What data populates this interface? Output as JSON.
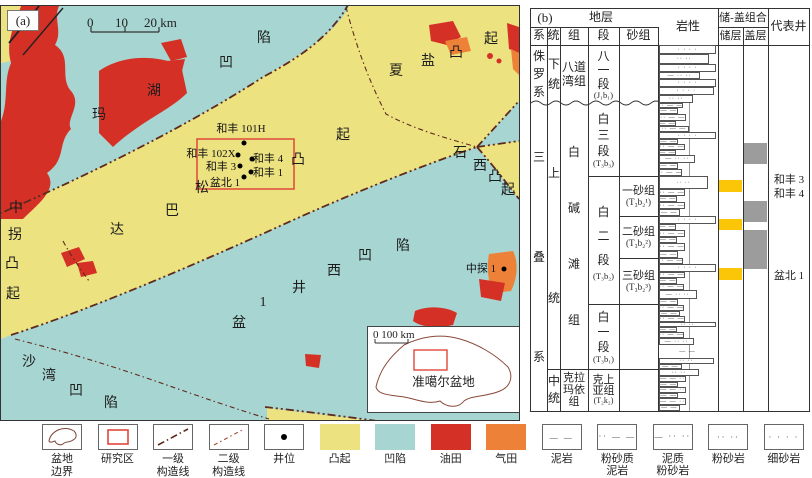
{
  "figure": {
    "panel_a_label": "(a)",
    "panel_b_label": "(b)"
  },
  "colors": {
    "uplift_yellow": "#ece280",
    "depression_teal": "#a7d5d1",
    "oilfield_red": "#d53026",
    "gasfield_orange": "#ee8138",
    "structure_line": "#5f2a1e",
    "study_rect_red": "#e0483a",
    "reservoir_yellow": "#fbc608",
    "cap_gray": "#9c9c9c"
  },
  "map": {
    "scalebar": {
      "t0": "0",
      "t10": "10",
      "t20": "20 km"
    },
    "region_labels": [
      {
        "t": "玛",
        "x": 98,
        "y": 113
      },
      {
        "t": "湖",
        "x": 153,
        "y": 89
      },
      {
        "t": "凹",
        "x": 225,
        "y": 61
      },
      {
        "t": "陷",
        "x": 263,
        "y": 36
      },
      {
        "t": "夏",
        "x": 395,
        "y": 69
      },
      {
        "t": "盐",
        "x": 427,
        "y": 59
      },
      {
        "t": "凸",
        "x": 455,
        "y": 51
      },
      {
        "t": "起",
        "x": 490,
        "y": 37
      },
      {
        "t": "达",
        "x": 116,
        "y": 228
      },
      {
        "t": "巴",
        "x": 171,
        "y": 209
      },
      {
        "t": "松",
        "x": 201,
        "y": 186
      },
      {
        "t": "凸",
        "x": 297,
        "y": 158
      },
      {
        "t": "起",
        "x": 342,
        "y": 133
      },
      {
        "t": "中",
        "x": 15,
        "y": 206
      },
      {
        "t": "拐",
        "x": 14,
        "y": 233
      },
      {
        "t": "凸",
        "x": 11,
        "y": 262
      },
      {
        "t": "起",
        "x": 12,
        "y": 292
      },
      {
        "t": "沙",
        "x": 28,
        "y": 360
      },
      {
        "t": "湾",
        "x": 48,
        "y": 374
      },
      {
        "t": "凹",
        "x": 75,
        "y": 389
      },
      {
        "t": "陷",
        "x": 110,
        "y": 401
      },
      {
        "t": "盆",
        "x": 238,
        "y": 321
      },
      {
        "t": "1",
        "x": 262,
        "y": 302
      },
      {
        "t": "井",
        "x": 298,
        "y": 286
      },
      {
        "t": "西",
        "x": 333,
        "y": 269
      },
      {
        "t": "凹",
        "x": 364,
        "y": 254
      },
      {
        "t": "陷",
        "x": 402,
        "y": 244
      },
      {
        "t": "石",
        "x": 459,
        "y": 151
      },
      {
        "t": "西",
        "x": 479,
        "y": 164
      },
      {
        "t": "凸",
        "x": 494,
        "y": 175
      },
      {
        "t": "起",
        "x": 507,
        "y": 188
      }
    ],
    "wells": [
      {
        "name": "和丰 101H",
        "lx": 240,
        "ly": 127,
        "dx": 243,
        "dy": 142
      },
      {
        "name": "和丰 102X",
        "lx": 210,
        "ly": 152,
        "dx": 237,
        "dy": 154
      },
      {
        "name": "和丰 4",
        "lx": 267,
        "ly": 157,
        "dx": 251,
        "dy": 158
      },
      {
        "name": "和丰 3",
        "lx": 220,
        "ly": 165,
        "dx": 239,
        "dy": 165
      },
      {
        "name": "和丰 1",
        "lx": 267,
        "ly": 171,
        "dx": 250,
        "dy": 171
      },
      {
        "name": "盆北 1",
        "lx": 224,
        "ly": 181,
        "dx": 243,
        "dy": 176
      },
      {
        "name": "中探 1",
        "lx": 480,
        "ly": 267,
        "dx": 503,
        "dy": 268
      }
    ],
    "inset": {
      "scale": "0    100 km",
      "label": "准噶尔盆地"
    }
  },
  "strat": {
    "header": {
      "dc": "地层",
      "sys": "系",
      "ser": "统",
      "fm": "组",
      "mem": "段",
      "sand": "砂组",
      "lith": "岩性",
      "rc": "储-盖组合",
      "res": "储层",
      "cap": "盖层",
      "rep": "代表井"
    },
    "cells": {
      "j_sys": "侏罗系",
      "j_ser": "下统",
      "j_fm": "八道湾组",
      "j_mem": "八一段",
      "j_mem_sub": "(J₁b₁)",
      "t_sys": "三叠系",
      "t_ser_u": "上统",
      "t_ser_m": "中统",
      "t_fm_b": "白碱滩组",
      "t_fm_k": "克拉玛依组",
      "b3": "白三段",
      "b3_sub": "(T₃b₃)",
      "b2": "白二段",
      "b2_sub": "(T₃b₂)",
      "b1": "白一段",
      "b1_sub": "(T₃b₁)",
      "k2": "克上亚组",
      "k2_sub": "(T₂k₂)",
      "sg1": "一砂组",
      "sg1_sub": "(T₃b₂¹)",
      "sg2": "二砂组",
      "sg2_sub": "(T₃b₂²)",
      "sg3": "三砂组",
      "sg3_sub": "(T₃b₂³)"
    },
    "rep_wells": [
      {
        "t": "和丰 3",
        "y": 162
      },
      {
        "t": "和丰 4",
        "y": 176
      },
      {
        "t": "盆北 1",
        "y": 258
      }
    ],
    "reservoir_blocks": [
      {
        "top": 171,
        "h": 12
      },
      {
        "top": 210,
        "h": 11
      },
      {
        "top": 259,
        "h": 12
      }
    ],
    "cap_blocks": [
      {
        "top": 134,
        "h": 21
      },
      {
        "top": 192,
        "h": 21
      },
      {
        "top": 221,
        "h": 39
      }
    ],
    "patterns": {
      "m": "— —",
      "sm": "·· — —",
      "as": "— ·· ··",
      "s": "·· ··",
      "f": "· · · ·",
      "ms": "— — ··"
    },
    "beds": [
      {
        "h": 9,
        "w": 100,
        "p": "f"
      },
      {
        "h": 10,
        "w": 88,
        "p": "s"
      },
      {
        "h": 8,
        "w": 100,
        "p": "f"
      },
      {
        "h": 7,
        "w": 72,
        "p": "as"
      },
      {
        "h": 8,
        "w": 100,
        "p": "f"
      },
      {
        "h": 8,
        "w": 96,
        "p": "f"
      },
      {
        "h": 8,
        "w": 60,
        "p": "s"
      },
      {
        "h": 5,
        "w": 42,
        "p": "sm"
      },
      {
        "h": 6,
        "w": 34,
        "p": "m"
      },
      {
        "h": 7,
        "w": 48,
        "p": "sm"
      },
      {
        "h": 5,
        "w": 30,
        "p": "m"
      },
      {
        "h": 6,
        "w": 52,
        "p": "sm"
      },
      {
        "h": 7,
        "w": 100,
        "p": "f"
      },
      {
        "h": 5,
        "w": 34,
        "p": "m"
      },
      {
        "h": 6,
        "w": 46,
        "p": "sm"
      },
      {
        "h": 5,
        "w": 30,
        "p": "m"
      },
      {
        "h": 8,
        "w": 64,
        "p": "as"
      },
      {
        "h": 6,
        "w": 34,
        "p": "m"
      },
      {
        "h": 7,
        "w": 40,
        "p": "sm"
      },
      {
        "h": 13,
        "w": 86,
        "p": "s"
      },
      {
        "h": 7,
        "w": 46,
        "p": "sm"
      },
      {
        "h": 6,
        "w": 32,
        "p": "m"
      },
      {
        "h": 7,
        "w": 46,
        "p": "sm"
      },
      {
        "h": 7,
        "w": 36,
        "p": "m"
      },
      {
        "h": 8,
        "w": 100,
        "p": "f"
      },
      {
        "h": 6,
        "w": 30,
        "p": "m"
      },
      {
        "h": 7,
        "w": 46,
        "p": "sm"
      },
      {
        "h": 6,
        "w": 32,
        "p": "m"
      },
      {
        "h": 8,
        "w": 46,
        "p": "sm"
      },
      {
        "h": 7,
        "w": 34,
        "p": "m"
      },
      {
        "h": 6,
        "w": 42,
        "p": "sm"
      },
      {
        "h": 8,
        "w": 100,
        "p": "f"
      },
      {
        "h": 6,
        "w": 46,
        "p": "sm"
      },
      {
        "h": 6,
        "w": 32,
        "p": "m"
      },
      {
        "h": 6,
        "w": 44,
        "p": "sm"
      },
      {
        "h": 9,
        "w": 66,
        "p": "as"
      },
      {
        "h": 6,
        "w": 34,
        "p": "m"
      },
      {
        "h": 6,
        "w": 44,
        "p": "sm"
      },
      {
        "h": 5,
        "w": 36,
        "p": "m"
      },
      {
        "h": 6,
        "w": 46,
        "p": "sm"
      },
      {
        "h": 5,
        "w": 100,
        "p": "s"
      },
      {
        "h": 5,
        "w": 32,
        "p": "m"
      },
      {
        "h": 6,
        "w": 44,
        "p": "sm"
      },
      {
        "h": 7,
        "w": 62,
        "p": "as"
      },
      {
        "h": 13,
        "w": 0,
        "p": "m"
      },
      {
        "h": 6,
        "w": 96,
        "p": "s"
      },
      {
        "h": 5,
        "w": 40,
        "p": "m"
      },
      {
        "h": 7,
        "w": 70,
        "p": "s"
      },
      {
        "h": 6,
        "w": 48,
        "p": "ms"
      },
      {
        "h": 5,
        "w": 34,
        "p": "m"
      },
      {
        "h": 6,
        "w": 48,
        "p": "ms"
      },
      {
        "h": 5,
        "w": 34,
        "p": "m"
      },
      {
        "h": 7,
        "w": 48,
        "p": "ms"
      },
      {
        "h": 6,
        "w": 36,
        "p": "m"
      }
    ]
  },
  "legend": {
    "items": [
      {
        "kind": "basin",
        "label": [
          "盆地",
          "边界"
        ]
      },
      {
        "kind": "study",
        "label": [
          "研究区"
        ]
      },
      {
        "kind": "line1",
        "label": [
          "一级",
          "构造线"
        ]
      },
      {
        "kind": "line2",
        "label": [
          "二级",
          "构造线"
        ]
      },
      {
        "kind": "well",
        "label": [
          "井位"
        ]
      },
      {
        "kind": "fill",
        "color": "#ece280",
        "label": [
          "凸起"
        ]
      },
      {
        "kind": "fill",
        "color": "#a7d5d1",
        "label": [
          "凹陷"
        ]
      },
      {
        "kind": "fill",
        "color": "#d53026",
        "label": [
          "油田"
        ]
      },
      {
        "kind": "fill",
        "color": "#ee8138",
        "label": [
          "气田"
        ]
      },
      {
        "kind": "pattern",
        "sym": "— —",
        "label": [
          "泥岩"
        ]
      },
      {
        "kind": "pattern",
        "sym": "·· — —",
        "label": [
          "粉砂质",
          "泥岩"
        ]
      },
      {
        "kind": "pattern",
        "sym": "— ·· ··",
        "label": [
          "泥质",
          "粉砂岩"
        ]
      },
      {
        "kind": "pattern",
        "sym": "·· ··",
        "label": [
          "粉砂岩"
        ]
      },
      {
        "kind": "pattern",
        "sym": "· · · ·",
        "label": [
          "细砂岩"
        ]
      }
    ]
  }
}
